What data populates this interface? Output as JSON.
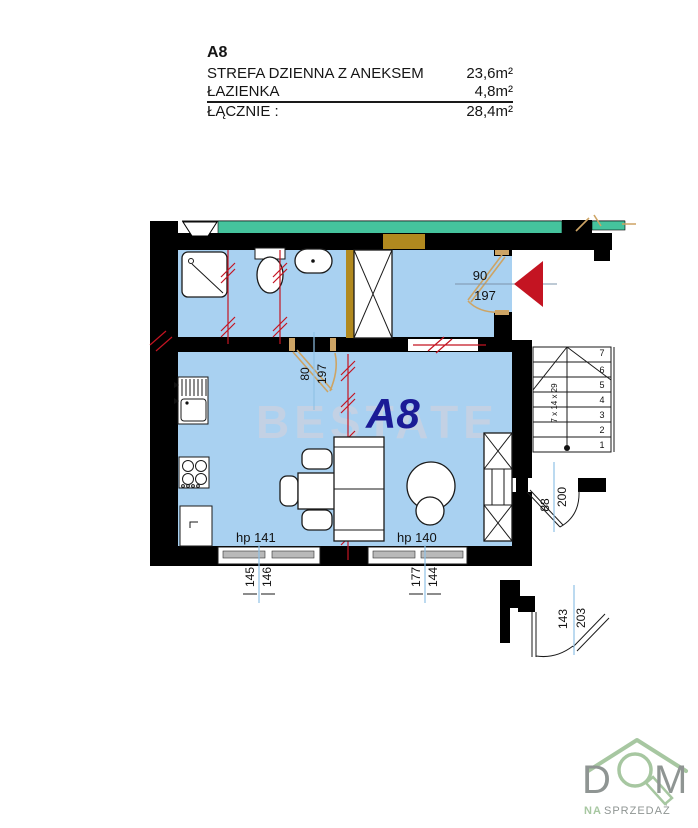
{
  "colors": {
    "floor": "#a9d1f1",
    "teal": "#45c39d",
    "olive": "#b1891f",
    "red": "#c41422",
    "tan": "#cda465",
    "dim": "#8fc1e6",
    "navy": "#1b1b96",
    "wm": "#c8d2e2",
    "logo_green": "#a7c7a1",
    "logo_gray": "#8f9593"
  },
  "info": {
    "unit": "A8",
    "rows": [
      {
        "label": "STREFA DZIENNA Z ANEKSEM",
        "value": "23,6m²"
      },
      {
        "label": "ŁAZIENKA",
        "value": "4,8m²"
      },
      {
        "label": "ŁĄCZNIE :",
        "value": "28,4m²"
      }
    ]
  },
  "plan": {
    "unit_label": "A8",
    "watermark": "BESTATE",
    "entry_door": {
      "width": "90",
      "height": "197"
    },
    "bathroom_door": {
      "width": "80",
      "height": "197"
    },
    "windows": [
      {
        "label": "hp 141",
        "dim_a": "145",
        "dim_b": "146"
      },
      {
        "label": "hp 140",
        "dim_a": "177",
        "dim_b": "144"
      }
    ],
    "stair_door": {
      "width": "88",
      "height": "200"
    },
    "lower_door": {
      "width": "143",
      "height": "203"
    },
    "stairs": {
      "note": "7 x 14 x 29",
      "steps": [
        "1",
        "2",
        "3",
        "4",
        "5",
        "6",
        "7"
      ]
    }
  },
  "logo": {
    "word_start": "D",
    "word_end": "M",
    "tagline_accent": "NA",
    "tagline_rest": "SPRZEDAŻ"
  }
}
